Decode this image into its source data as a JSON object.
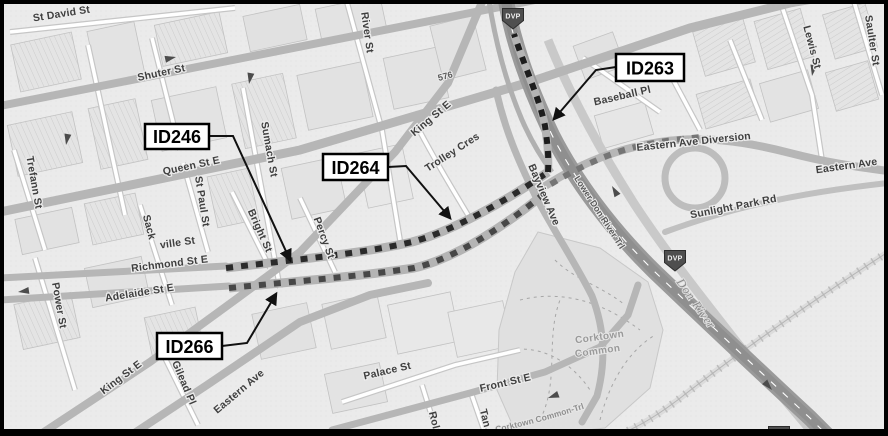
{
  "labels": [
    "St David St",
    "Shuter St",
    "River St",
    "576",
    "Trefann St",
    "Queen St E",
    "Sumach St",
    "St Paul St",
    "Power St",
    "Sack",
    "ville St",
    "Bright St",
    "Percy St",
    "King St E",
    "Trolley Cres",
    "Richmond St E",
    "Adelaide St E",
    "Bayview Ave",
    "Lower Don River Trl",
    "Baseball Pl",
    "Lewis St",
    "Saulter St",
    "Eastern Ave Diversion",
    "Eastern Ave",
    "Sunlight Park Rd",
    "Don River",
    "Corktown",
    "Common",
    "Corktown Common-Trl",
    "Palace St",
    "Front St E",
    "King St E",
    "Gilead Pl",
    "Eastern Ave",
    "Rol",
    "Tan"
  ],
  "callouts": [
    "ID246",
    "ID264",
    "ID263",
    "ID266"
  ],
  "shield": "DVP",
  "colors": {
    "map_background": "#ebebeb",
    "road_major": "#b6b6b6",
    "highway": "#9a9a9a",
    "route_richmond_dash": "#2a2a2a",
    "route_adelaide_dash": "#474747",
    "route_diversion_dash": "#757575",
    "route_dvp_branch_dash": "#1d1d1d",
    "callout_border": "#000000",
    "callout_fill": "#ffffff"
  }
}
